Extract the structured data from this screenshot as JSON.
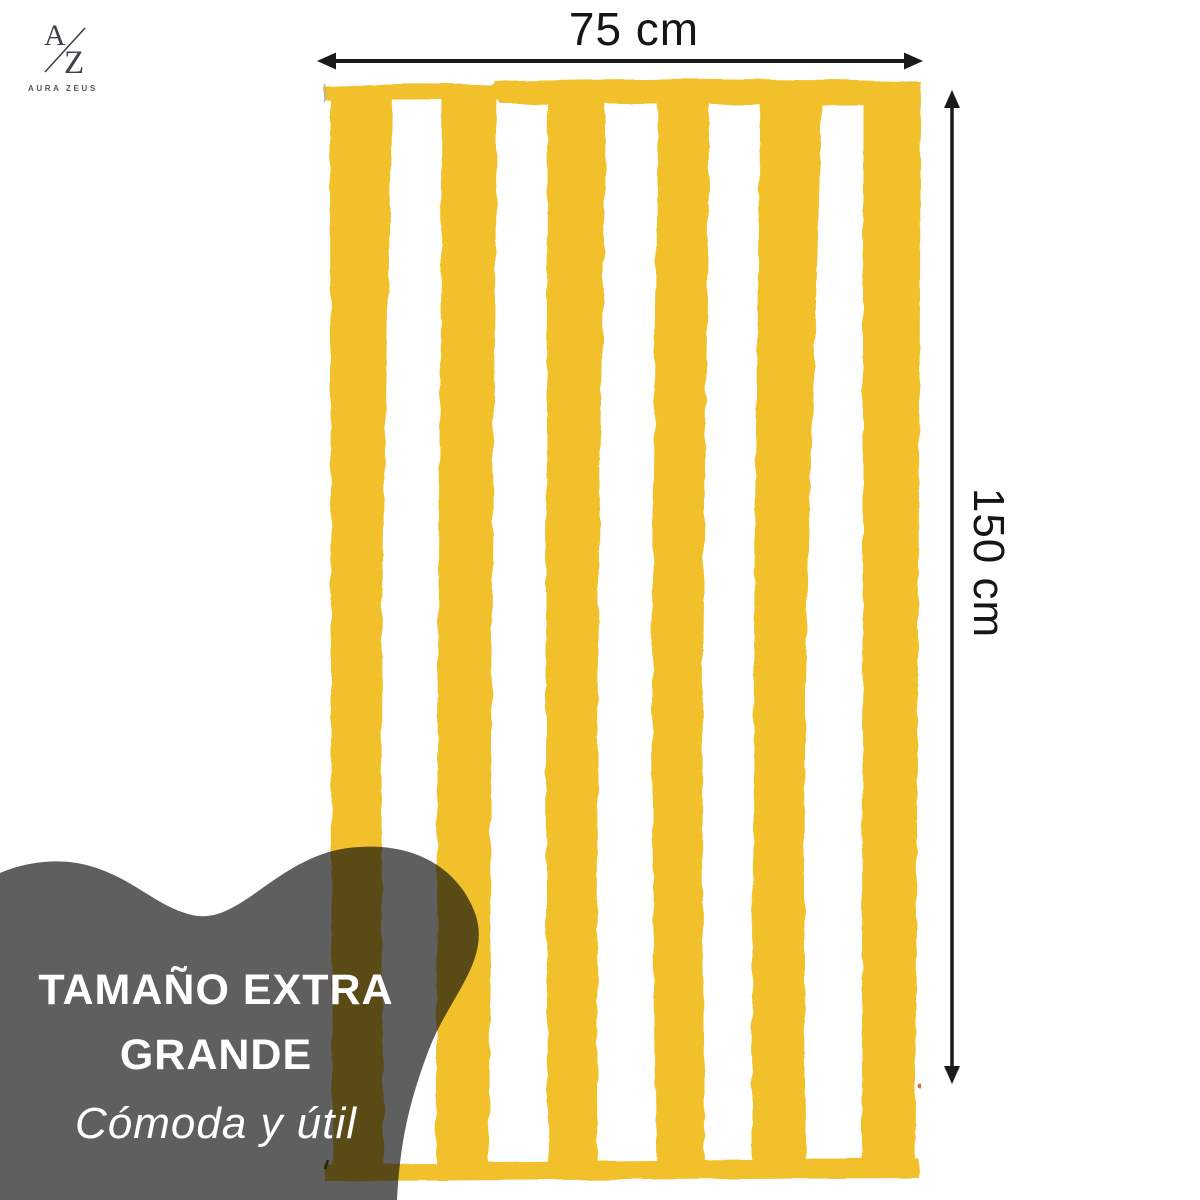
{
  "page": {
    "background_color": "#FFFFFF"
  },
  "brand": {
    "monogram_a": "A",
    "monogram_z": "Z",
    "name": "AURA ZEUS"
  },
  "dimensions": {
    "width_label": "75 cm",
    "height_label": "150 cm"
  },
  "callout": {
    "title_line1": "TAMAÑO EXTRA",
    "title_line2": "GRANDE",
    "subtitle": "Cómoda y útil"
  },
  "towel": {
    "stripe_count": 6,
    "stripe_color": "#F1C02B",
    "base_color": "#FFFFFF"
  },
  "theme": {
    "arrow_color": "#1A1A1A",
    "label_color": "#161616",
    "blob_color": "rgba(12,12,12,0.66)",
    "callout_text_color": "#FFFFFF",
    "logo_color": "#3E4247",
    "brand_text_color": "#54585C"
  }
}
